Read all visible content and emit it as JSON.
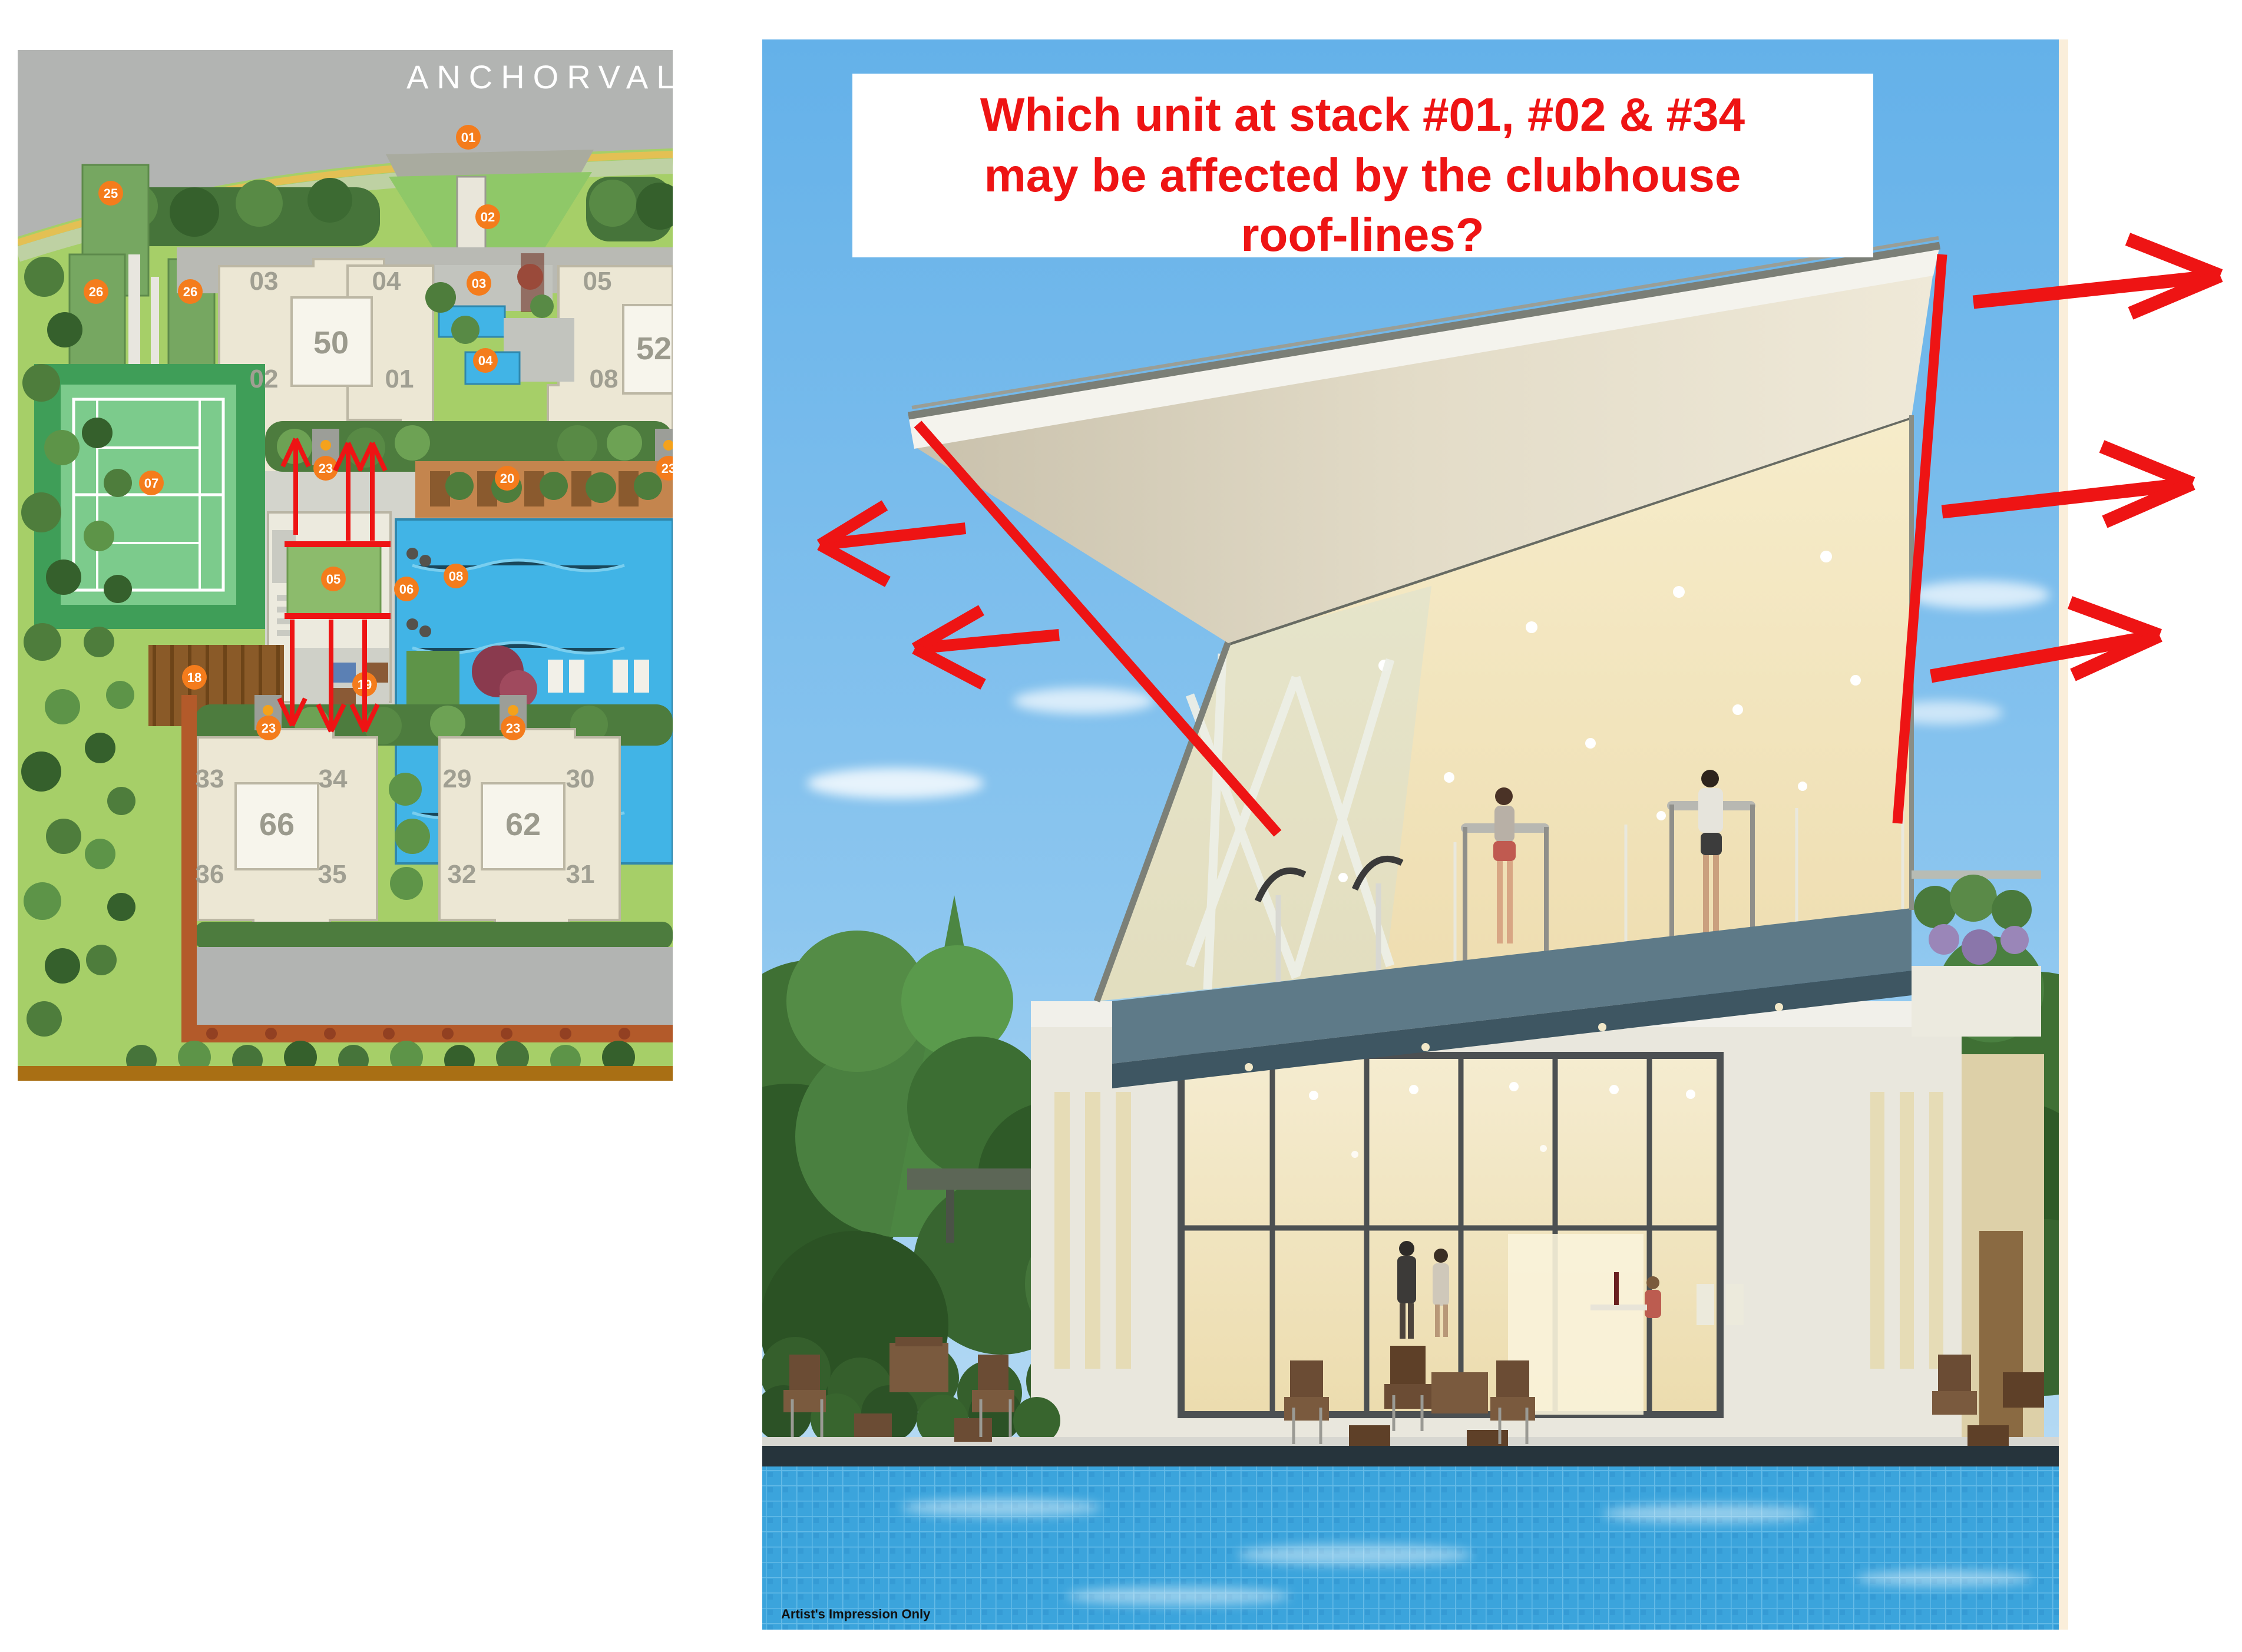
{
  "title_box": {
    "line1": "Which unit at stack #01, #02 & #34",
    "line2": "may be affected by the clubhouse",
    "line3": "roof-lines?",
    "text_color": "#ee1414",
    "background": "#ffffff"
  },
  "site_map": {
    "road_name": "ANCHORVALE",
    "marker_color": "#f47c1c",
    "tower_labels": {
      "t50": "50",
      "t52": "52",
      "t66": "66",
      "t62": "62"
    },
    "unit_labels": {
      "u03": "03",
      "u04": "04",
      "u05": "05",
      "u02": "02",
      "u01": "01",
      "u08": "08",
      "u33": "33",
      "u34": "34",
      "u29": "29",
      "u30": "30",
      "u36": "36",
      "u35": "35",
      "u32": "32",
      "u31": "31"
    },
    "marker_labels": {
      "m01": "01",
      "m02": "02",
      "m03": "03",
      "m04": "04",
      "m05": "05",
      "m06": "06",
      "m07": "07",
      "m08": "08",
      "m18": "18",
      "m19": "19",
      "m20": "20",
      "m23a": "23",
      "m23b": "23",
      "m23c": "23",
      "m23d": "23",
      "m25": "25",
      "m26a": "26",
      "m26b": "26"
    }
  },
  "rendering": {
    "caption": "Artist's Impression Only"
  },
  "annotations": {
    "arrow_color": "#ee1414",
    "left_arrow_count": 2,
    "right_arrow_count": 3,
    "map_up_arrow_count": 3,
    "map_down_arrow_count": 3
  }
}
